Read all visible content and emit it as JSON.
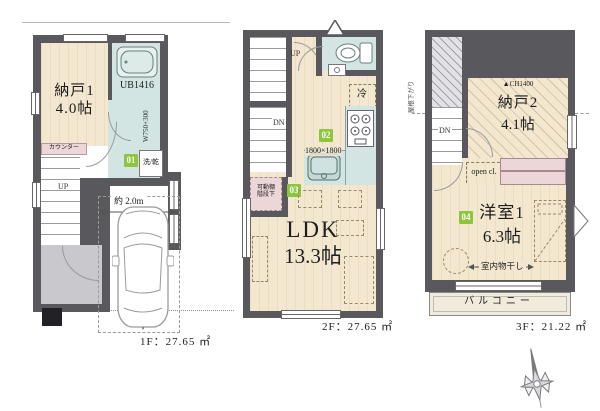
{
  "floors": {
    "f1": {
      "area": "1F：27.65 ㎡",
      "storage_name": "納戸1",
      "storage_size": "4.0帖",
      "bath": "UB1416",
      "width_note": "W750+300",
      "badge": "01",
      "washer": "洗/乾",
      "counter": "カウンター",
      "up": "UP",
      "dim_width": "約 2.0m",
      "dim_depth": "約 4.0m"
    },
    "f2": {
      "area": "2F：27.65 ㎡",
      "up": "UP",
      "dn": "DN",
      "fridge": "冷",
      "badge_kitchen": "02",
      "kitchen_dim": "1800×1800",
      "shelf_line1": "可動棚",
      "shelf_line2": "階段下",
      "badge_shelf": "03",
      "ldk_name": "LDK",
      "ldk_size": "13.3帖"
    },
    "f3": {
      "area": "3F：21.22 ㎡",
      "roof_note": "屋根下がり",
      "dn": "DN",
      "ch_note": "▲CH1400",
      "storage_name": "納戸2",
      "storage_size": "4.1帖",
      "open_closet": "open cl.",
      "badge_room": "04",
      "room_name": "洋室1",
      "room_size": "6.3帖",
      "drying": "室内物干し",
      "balcony": "バルコニー"
    }
  },
  "colors": {
    "wall": "#58585d",
    "floor_beige": "#f3e7cf",
    "wet_cyan": "#d3e5e3",
    "closet_pink": "#ecd6d8",
    "badge_green": "#8dc53e",
    "entrance_gray": "#c9c9cd"
  },
  "icons": [
    "bathtub-icon",
    "washer-icon",
    "toilet-icon",
    "hand-sink-icon",
    "stove-icon",
    "kitchen-sink-icon",
    "fridge-icon",
    "car-icon",
    "compass-icon",
    "vent-triangle-icon",
    "casement-window-icon"
  ]
}
